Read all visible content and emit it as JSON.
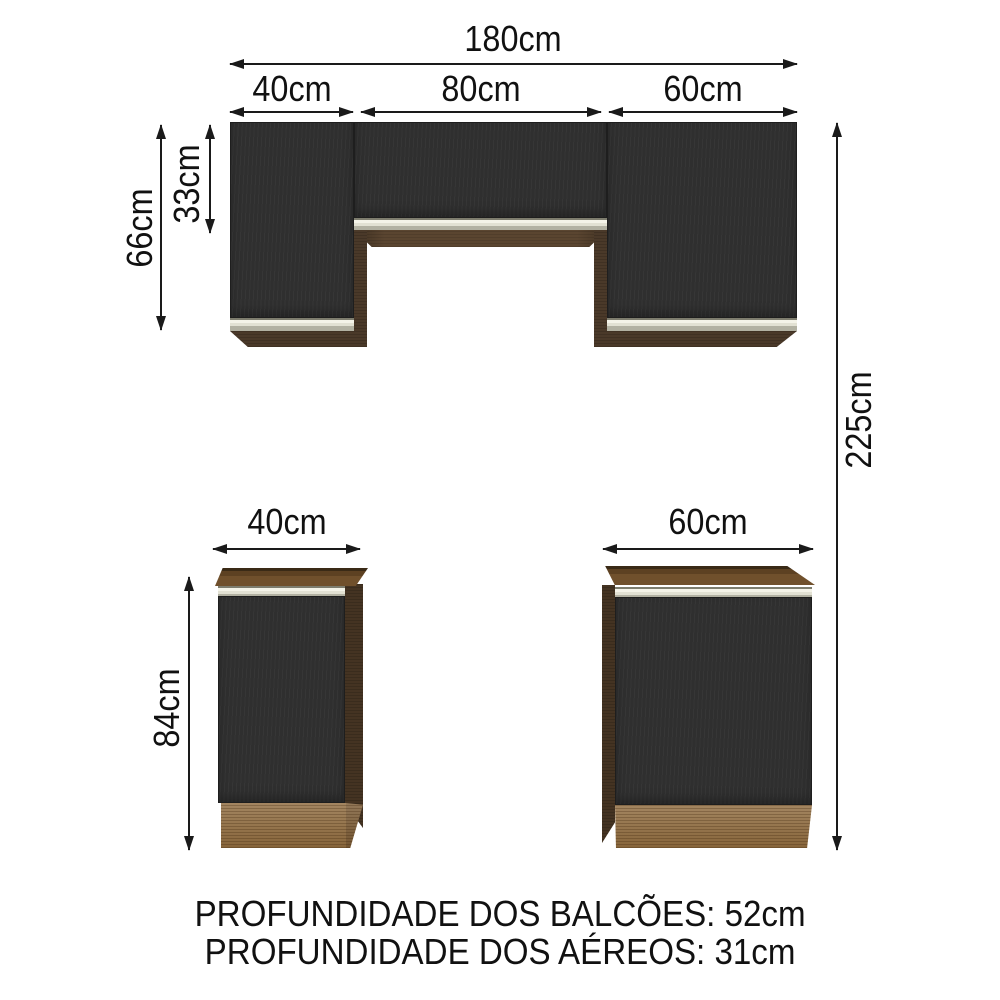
{
  "dimensions": {
    "wall_total_width": "180cm",
    "wall_left_width": "40cm",
    "wall_middle_width": "80cm",
    "wall_right_width": "60cm",
    "wall_height": "66cm",
    "wall_middle_door_height": "33cm",
    "total_height": "225cm",
    "base_left_width": "40cm",
    "base_right_width": "60cm",
    "base_height": "84cm"
  },
  "footer": {
    "balcoes_depth": "PROFUNDIDADE DOS BALCÕES: 52cm",
    "aereos_depth": "PROFUNDIDADE DOS AÉREOS: 31cm"
  },
  "colors": {
    "background": "#ffffff",
    "arrow_and_text": "#1a1a1a",
    "door_black": "#2f2f2f",
    "wood_dark_brown": "#4a3929",
    "countertop_brown": "#6b4a27",
    "plinth_wood": "#8f6b3e",
    "handle_silver": "#e2e1d3"
  }
}
